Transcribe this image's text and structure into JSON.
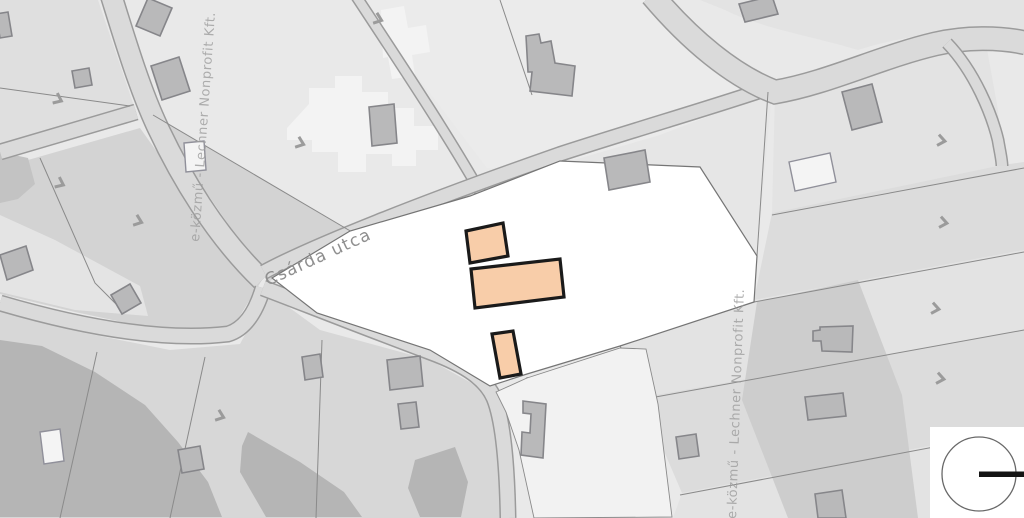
{
  "map": {
    "street_label": "Csárda utca",
    "watermark": "e-közmű - Lechner Nonprofit Kft.",
    "highlighted_buildings": [
      {
        "id": 1,
        "points": "466,231 503,223 508,256 470,263"
      },
      {
        "id": 2,
        "points": "471,269 560,259 564,297 475,308"
      },
      {
        "id": 3,
        "points": "492,334 513,331 521,374 500,378"
      }
    ],
    "direction_arrows": [
      {
        "x": 55,
        "y": 98,
        "angle": 25
      },
      {
        "x": 375,
        "y": 18,
        "angle": 20
      },
      {
        "x": 297,
        "y": 142,
        "angle": 20
      },
      {
        "x": 57,
        "y": 182,
        "angle": 25
      },
      {
        "x": 135,
        "y": 220,
        "angle": 20
      },
      {
        "x": 217,
        "y": 415,
        "angle": 20
      },
      {
        "x": 938,
        "y": 140,
        "angle": 10
      },
      {
        "x": 940,
        "y": 222,
        "angle": 10
      },
      {
        "x": 932,
        "y": 308,
        "angle": 10
      },
      {
        "x": 937,
        "y": 378,
        "angle": 10
      }
    ],
    "colors": {
      "parcel-base": "#e9e9e9",
      "parcel-dark": "#d3d3d3",
      "parcel-shadow": "#b5b5b5",
      "road-fill": "#dadada",
      "road-edge": "#9b9b9b",
      "boundary": "#8a8a8a",
      "building-fill": "#b9b9ba",
      "building-stroke": "#86868a",
      "building-light-fill": "#f4f4f4",
      "white-parcel": "#ffffff",
      "highlight-fill": "#f8cda9",
      "highlight-stroke": "#1a1a1a",
      "label": "#8f8f8f",
      "watermark": "#9d9d9d",
      "arrow": "#9b9b9b",
      "needle": "#141414"
    }
  }
}
